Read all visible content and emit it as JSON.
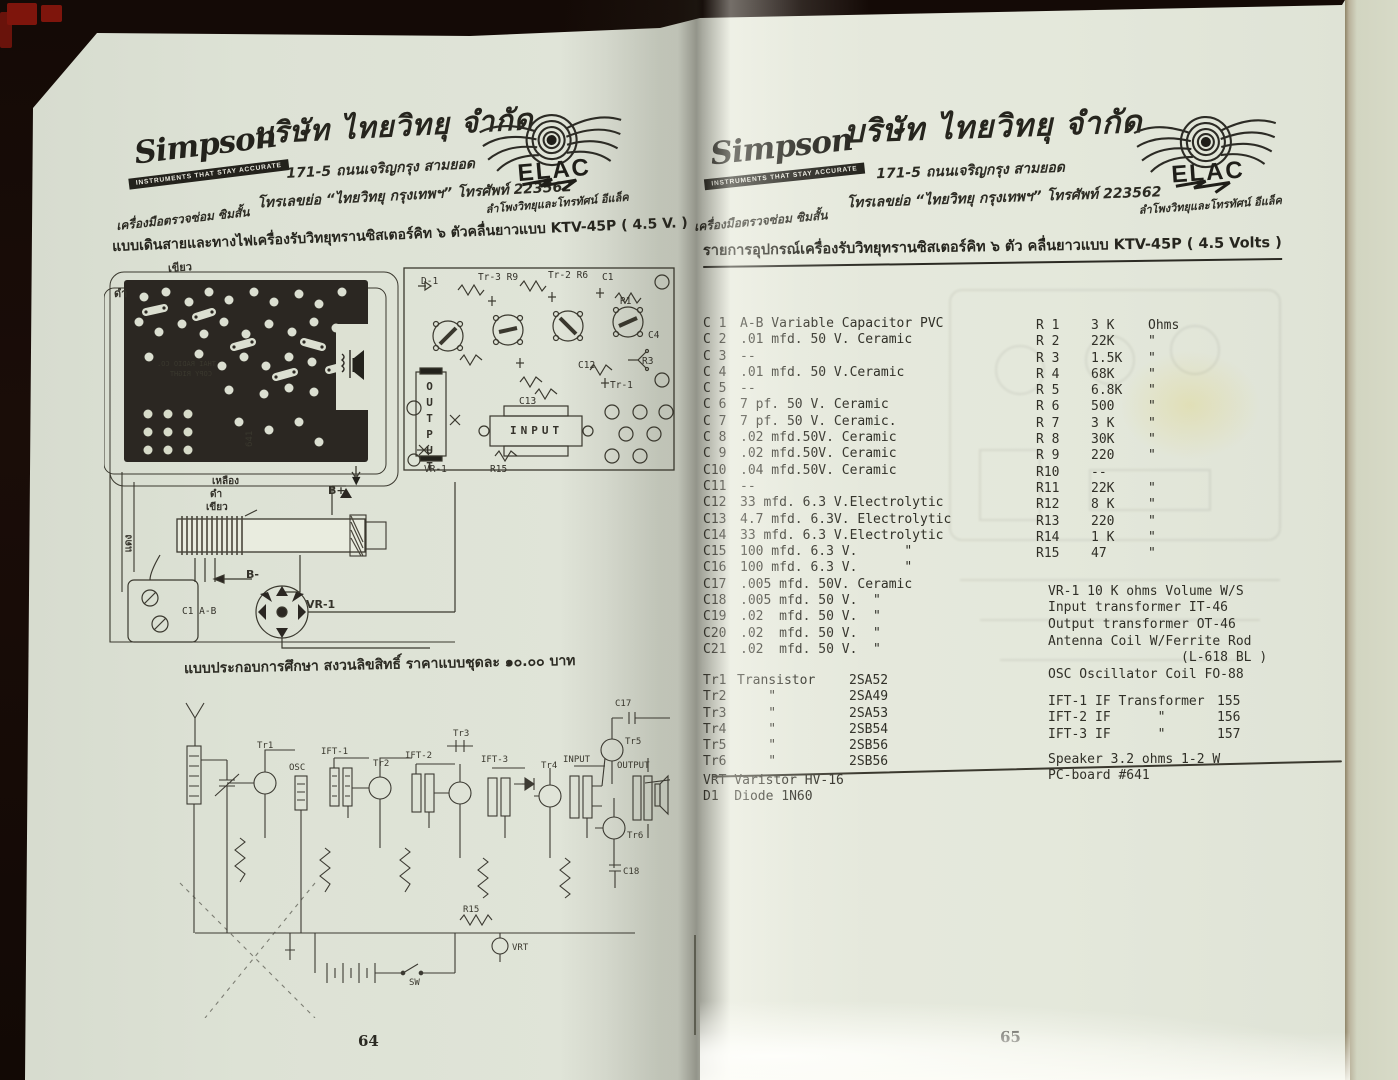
{
  "header": {
    "simpson_name": "Simpson",
    "simpson_banner": "INSTRUMENTS THAT STAY ACCURATE",
    "simpson_caption": "เครื่องมือตรวจซ่อม ซิมสั้น",
    "company_title": "บริษัท ไทยวิทยุ จำกัด",
    "address_line": "171-5 ถนนเจริญกรุง สามยอด",
    "contact_line": "โทรเลขย่อ “ไทยวิทยุ กรุงเทพฯ” โทรศัพท์ 223562",
    "elac_name": "ELAC",
    "elac_caption": "ลำโพงวิทยุและโทรทัศน์ อีแล็ค"
  },
  "left_page": {
    "heading": "แบบเดินสายและทางไฟเครื่องรับวิทยุทรานซิสเตอร์คิท ๖ ตัวคลื่นยาวแบบ KTV-45P ( 4.5 V. )",
    "caption": "แบบประกอบการศึกษา สงวนลิขสิทธิ์ ราคาแบบชุดละ ๑๐.๐๐ บาท",
    "page_number": "64",
    "wiring": {
      "green_top": "เขียว",
      "black_top": "ดำ",
      "yellow": "เหลือง",
      "black_mid": "ดำ",
      "green_mid": "เขียว",
      "red": "แดง",
      "b_plus": "B+",
      "b_minus": "B-",
      "vr1": "VR-1",
      "c1ab": "C1 A-B",
      "board_text1": "THAI RADIO CO.",
      "board_text2": "COPY RIGHT",
      "board_number": "641"
    },
    "layout": {
      "d1": "D-1",
      "tr3": "Tr-3 R9",
      "tr2": "Tr-2 R6",
      "c1": "C1",
      "r1": "R1",
      "c4": "C4",
      "r3": "R3",
      "tr1": "Tr-1",
      "c12": "C12",
      "c13": "C13",
      "vr1": "VR-1",
      "r15": "R15",
      "output": "OUTPUT",
      "input": "INPUT"
    },
    "schematic": {
      "tr1": "Tr1",
      "osc": "OSC",
      "ift1": "IFT-1",
      "tr2": "Tr2",
      "ift2": "IFT-2",
      "tr3": "Tr3",
      "ift3": "IFT-3",
      "tr4": "Tr4",
      "input": "INPUT",
      "tr5": "Tr5",
      "tr6": "Tr6",
      "c17": "C17",
      "c18": "C18",
      "output": "OUTPUT",
      "sw": "SW",
      "vrt": "VRT",
      "r15": "R15"
    }
  },
  "right_page": {
    "heading": "รายการอุปกรณ์เครื่องรับวิทยุทรานซิสเตอร์คิท ๖ ตัว คลื่นยาวแบบ KTV-45P ( 4.5 Volts )",
    "page_number": "65",
    "capacitors": [
      [
        "C 1",
        "A-B Variable Capacitor PVC"
      ],
      [
        "C 2",
        ".01 mfd. 50 V. Ceramic"
      ],
      [
        "C 3",
        "--"
      ],
      [
        "C 4",
        ".01 mfd. 50 V.Ceramic"
      ],
      [
        "C 5",
        "--"
      ],
      [
        "C 6",
        "7 pf. 50 V. Ceramic"
      ],
      [
        "C 7",
        "7 pf. 50 V. Ceramic."
      ],
      [
        "C 8",
        ".02 mfd.50V. Ceramic"
      ],
      [
        "C 9",
        ".02 mfd.50V. Ceramic"
      ],
      [
        "C10",
        ".04 mfd.50V. Ceramic"
      ],
      [
        "C11",
        "--"
      ],
      [
        "C12",
        "33 mfd. 6.3 V.Electrolytic"
      ],
      [
        "C13",
        "4.7 mfd. 6.3V. Electrolytic"
      ],
      [
        "C14",
        "33 mfd. 6.3 V.Electrolytic"
      ],
      [
        "C15",
        "100 mfd. 6.3 V.      \""
      ],
      [
        "C16",
        "100 mfd. 6.3 V.      \""
      ],
      [
        "C17",
        ".005 mfd. 50V. Ceramic"
      ],
      [
        "C18",
        ".005 mfd. 50 V.  \""
      ],
      [
        "C19",
        ".02  mfd. 50 V.  \""
      ],
      [
        "C20",
        ".02  mfd. 50 V.  \""
      ],
      [
        "C21",
        ".02  mfd. 50 V.  \""
      ]
    ],
    "transistors": [
      [
        "Tr1",
        "Transistor",
        "2SA52"
      ],
      [
        "Tr2",
        "    \"",
        "2SA49"
      ],
      [
        "Tr3",
        "    \"",
        "2SA53"
      ],
      [
        "Tr4",
        "    \"",
        "2SB54"
      ],
      [
        "Tr5",
        "    \"",
        "2SB56"
      ],
      [
        "Tr6",
        "    \"",
        "2SB56"
      ]
    ],
    "misc_parts": [
      "VRT Varistor HV-16",
      "D1  Diode 1N60"
    ],
    "resistors": [
      [
        "R 1",
        "3 K",
        "Ohms"
      ],
      [
        "R 2",
        "22K",
        "\""
      ],
      [
        "R 3",
        "1.5K",
        "\""
      ],
      [
        "R 4",
        "68K",
        "\""
      ],
      [
        "R 5",
        "6.8K",
        "\""
      ],
      [
        "R 6",
        "500",
        "\""
      ],
      [
        "R 7",
        "3 K",
        "\""
      ],
      [
        "R 8",
        "30K",
        "\""
      ],
      [
        "R 9",
        "220",
        "\""
      ],
      [
        "R10",
        "--",
        ""
      ],
      [
        "R11",
        "22K",
        "\""
      ],
      [
        "R12",
        "8 K",
        "\""
      ],
      [
        "R13",
        "220",
        "\""
      ],
      [
        "R14",
        "1 K",
        "\""
      ],
      [
        "R15",
        "47",
        "\""
      ]
    ],
    "controls": [
      "VR-1 10 K ohms Volume W/S",
      "Input transformer IT-46",
      "Output transformer OT-46"
    ],
    "antenna": [
      "Antenna Coil W/Ferrite Rod",
      "                 (L-618 BL )",
      "OSC Oscillator Coil FO-88"
    ],
    "ift": [
      [
        "IFT-1",
        "IF Transformer",
        "155"
      ],
      [
        "IFT-2",
        "IF      \"",
        "156"
      ],
      [
        "IFT-3",
        "IF      \"",
        "157"
      ]
    ],
    "output_parts": [
      "Speaker 3.2 ohms 1-2 W",
      "PC-board #641"
    ]
  }
}
